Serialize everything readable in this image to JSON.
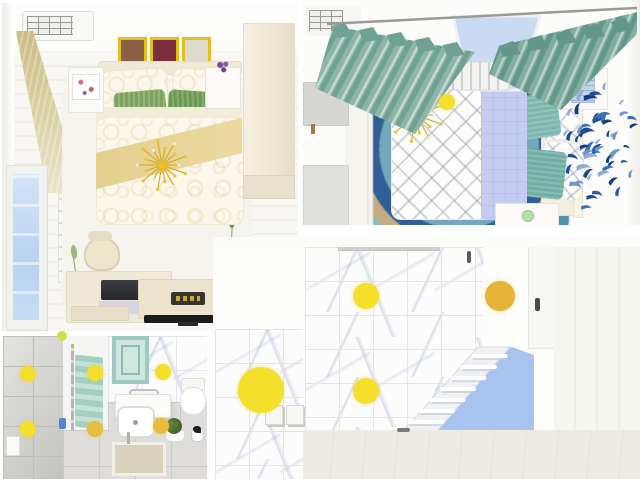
{
  "scene": {
    "type": "top-down 3d interior render of a four-room apartment",
    "rooms": [
      {
        "id": "bedroom-1",
        "position": "top-left",
        "objects": [
          "air-conditioner",
          "three-framed-pictures",
          "tan-curtain",
          "window",
          "radiator",
          "double-bed",
          "swirl-pillows",
          "green-pillows",
          "gold-blanket",
          "leaf-border-rug",
          "nightstand-with-book",
          "nightstand-with-flowers",
          "wardrobe",
          "gold-chandelier",
          "desk-with-laptop",
          "chair",
          "tv-cabinet",
          "flat-tv",
          "yellow-door-strip"
        ]
      },
      {
        "id": "bedroom-2",
        "position": "top-right",
        "objects": [
          "air-conditioner",
          "curtain-rod",
          "teal-curtains",
          "window",
          "radiator",
          "double-bed",
          "chevron-duvet",
          "periwinkle-blanket",
          "teal-pillows",
          "swirl-rug",
          "gold-chandelier",
          "nightstands",
          "blue-bird-wall-decor",
          "gray-cabinets"
        ]
      },
      {
        "id": "bathroom",
        "position": "bottom-left",
        "objects": [
          "gray-tiled-wall",
          "partition",
          "towel-rail",
          "teal-towel",
          "teal-mirror",
          "marble-wall",
          "sink-vanity",
          "toilet",
          "floor-mat",
          "moss-plant",
          "penguin-figure",
          "ceiling-spotlights"
        ]
      },
      {
        "id": "stair-hall",
        "position": "bottom-right",
        "objects": [
          "marble-tiled-wall",
          "gray-vent-panel",
          "staircase",
          "blue-runner",
          "white-door",
          "panel-wall",
          "small-floor-tiles",
          "ceiling-spotlights"
        ]
      }
    ]
  },
  "palette": {
    "gold": "#E9C428",
    "frame_gold": "#E4BD1E",
    "blanket": "#E3CF8E",
    "green_pillow_a": "#7CA45E",
    "green_pillow_b": "#6D9A52",
    "teal_pillow_a": "#7CB6AC",
    "teal_pillow_b": "#6FAEA3",
    "periwinkle": "#C4CDF1",
    "pool_blue": "#A9C3F0",
    "mirror_teal": "#9CCAC2",
    "mirror_inner": "#CFE6DE",
    "frame_img_1": "#8A6148",
    "frame_img_2": "#7A2E3E",
    "frame_img_3": "#DEDAD0",
    "laptop_screen": "#2C2C30",
    "laptop_keys": "#D7D3EA",
    "tv_black": "#1B1B1D",
    "logo_plate": "#35352B",
    "moss_green": "#47682E",
    "bottle_blue": "#4F86D6",
    "ball_chartreuse": "#CFE04A"
  },
  "lights": {
    "color": "#F4DF2B",
    "items": [
      {
        "x": 28,
        "y": 374,
        "r": 8
      },
      {
        "x": 95,
        "y": 373,
        "r": 8
      },
      {
        "x": 163,
        "y": 372,
        "r": 8
      },
      {
        "x": 28,
        "y": 429,
        "r": 8
      },
      {
        "x": 95,
        "y": 429,
        "r": 8,
        "c": "#E9BC3C"
      },
      {
        "x": 161,
        "y": 426,
        "r": 8,
        "c": "#E9BC3C"
      },
      {
        "x": 261,
        "y": 390,
        "r": 23
      },
      {
        "x": 366,
        "y": 296,
        "r": 13
      },
      {
        "x": 500,
        "y": 296,
        "r": 15,
        "c": "#E5B33A"
      },
      {
        "x": 366,
        "y": 391,
        "r": 13
      },
      {
        "x": 447,
        "y": 102,
        "r": 8
      }
    ]
  },
  "birds": {
    "count": 58,
    "seed": 11,
    "cx": 50,
    "cy": 84,
    "turns": 14.5,
    "inner": 7,
    "spread": 52,
    "colors": [
      "#1E4C94",
      "#3A70B4",
      "#6E96CC",
      "#123C7C",
      "#8FACD6",
      "#2B5AA4"
    ]
  },
  "chandelier": {
    "spoke_color": "#D8AC28",
    "bead_color": "#E8C63A",
    "center_color": "#EFC11E"
  }
}
